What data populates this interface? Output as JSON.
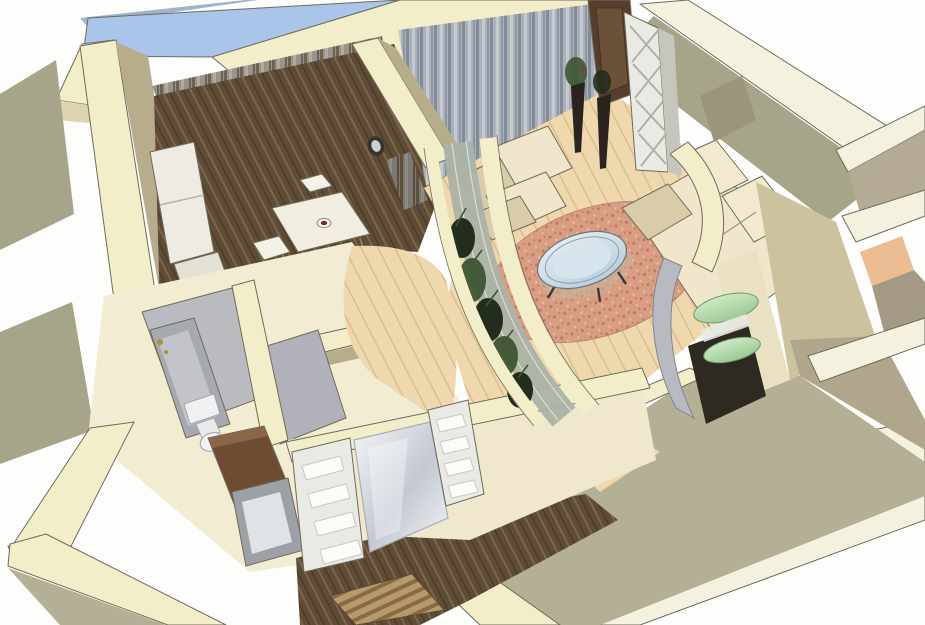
{
  "meta": {
    "description": "3D cutaway axonometric rendering of an apartment interior floor plan, viewed from above at an angle on a white background. No text, UI chrome or labels are visible in the image.",
    "view": "isometric-cutaway",
    "rooms": [
      "kitchen-dining",
      "living-room",
      "plant-partition-winter-garden",
      "display-room",
      "bathroom",
      "wc",
      "entry-hall"
    ]
  },
  "palette": {
    "bg": "#fdfdfc",
    "line": "#6f6b5a",
    "cream": "#f3eeca",
    "cream_light": "#f4f2df",
    "cream_dark": "#ddd5ad",
    "tan": "#b7ac8b",
    "tan_dark": "#a59a7b",
    "khaki": "#b3b096",
    "olive": "#a6a58a",
    "glass_blue": "#a9c6ea",
    "glass_blue_dark": "#8fb0d6",
    "frame_gray": "#9db4cd",
    "floor_pale": "#efd8ad",
    "floor_pale_line": "#dcbf8f",
    "floor_dark": "#5f4c36",
    "floor_dark_line": "#7c664a",
    "terracotta": "#d89d82",
    "terracotta_dot": "#bb7a60",
    "terracotta_dot2": "#e9bf9f",
    "curtain_base_a": "#9b9184",
    "curtain_s1": "#6e6352",
    "curtain_s2": "#b3aa9a",
    "curtain_s3": "#8e96a4",
    "curtain_base_b": "#aab1bb",
    "curtain_s4": "#c6c9ce",
    "curtain_s5": "#828b98",
    "upholstery": "#efe6cb",
    "upholstery_shadow": "#d9cda9",
    "plant_dark": "#232d1d",
    "plant_mid": "#3d5531",
    "door_wood": "#553f2c",
    "door_wood_light": "#6b5138",
    "hall_wood_panel": "#6e4c34",
    "fixture_gray": "#a7a9b0",
    "fixture_gray_light": "#c2c4ca",
    "floor_gray": "#babbc1",
    "glass_partition": "#aab3a6",
    "green_glass": "#9fcb97",
    "green_glass_light": "#d2ecc9",
    "frosted_light": "#f4f6f8",
    "frosted_dark": "#c3c8d2",
    "shelf_white": "#fbfbf7",
    "unit_white": "#eaeae4",
    "gold": "#b08c3c",
    "mat_a": "#8a6a42",
    "mat_b": "#b59a6c",
    "red_accent": "#7c2822",
    "table_glass_1": "#e8eef2",
    "table_glass_2": "#bcd2de"
  },
  "objects": {
    "skylight": "blue glazed window band along upper-left wall",
    "dining_set": "white square table with centerpiece and chairs",
    "kitchen_units": "white cabinet fronts along left wall",
    "wall_clock": "dark oval clock on dining/living divider wall",
    "curtains": "floor-length striped curtains on the two window walls",
    "living_set": "cream armchair, cream corner sofa, round glass coffee table",
    "floor_circle": "speckled terracotta circular floor inlay",
    "floor_vases": "two tall dark floor vases with sprigs",
    "trellis_shelf": "white etagere with X-braces beside dark open door",
    "winter_garden": "curved glazed partition filled with dark green plants",
    "display_unit": "curved niche with green glass shelves in right room",
    "bathroom_set": "gray bathtub with gold faucet and white toilet",
    "hall_wardrobe": "built-in wardrobe with frosted panel and white shelf columns",
    "door_mat": "striped mat at the entry",
    "walls": "thick cut-away wall tops in pale cream with olive outer faces"
  }
}
